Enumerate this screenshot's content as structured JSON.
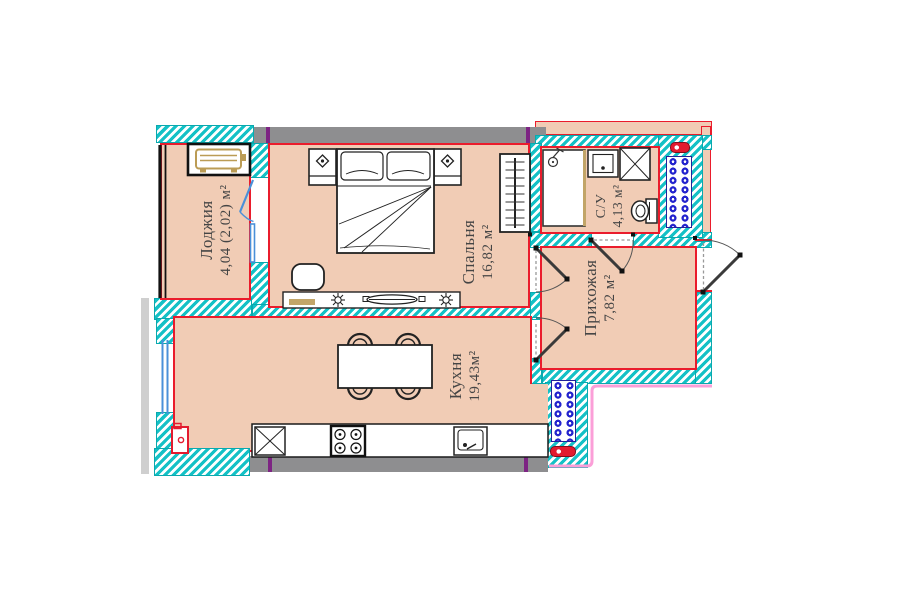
{
  "plan_type": "apartment-floor-plan",
  "rooms": {
    "loggia": {
      "name": "Лоджия",
      "area": "4,04 (2,02) м²"
    },
    "bedroom": {
      "name": "Спальня",
      "area": "16,82 м²"
    },
    "bathroom": {
      "name": "С/У",
      "area": "4,13 м²"
    },
    "hallway": {
      "name": "Прихожая",
      "area": "7,82 м²"
    },
    "kitchen": {
      "name": "Кухня",
      "area": "19,43м²"
    }
  },
  "colors": {
    "floor_fill": "#f1ccb5",
    "wall_hatch_teal": "#14c1c6",
    "wall_concrete_gray": "#8e8e90",
    "outline_red": "#ea1c2c",
    "axis_marker_purple": "#7d2483",
    "window_blue": "#4a90d9",
    "vent_grille_blue": "#2323cd",
    "furniture_tan": "#c2a568",
    "neighbor_outline_pink": "#fb9fd8",
    "glazing_black": "#111111"
  }
}
